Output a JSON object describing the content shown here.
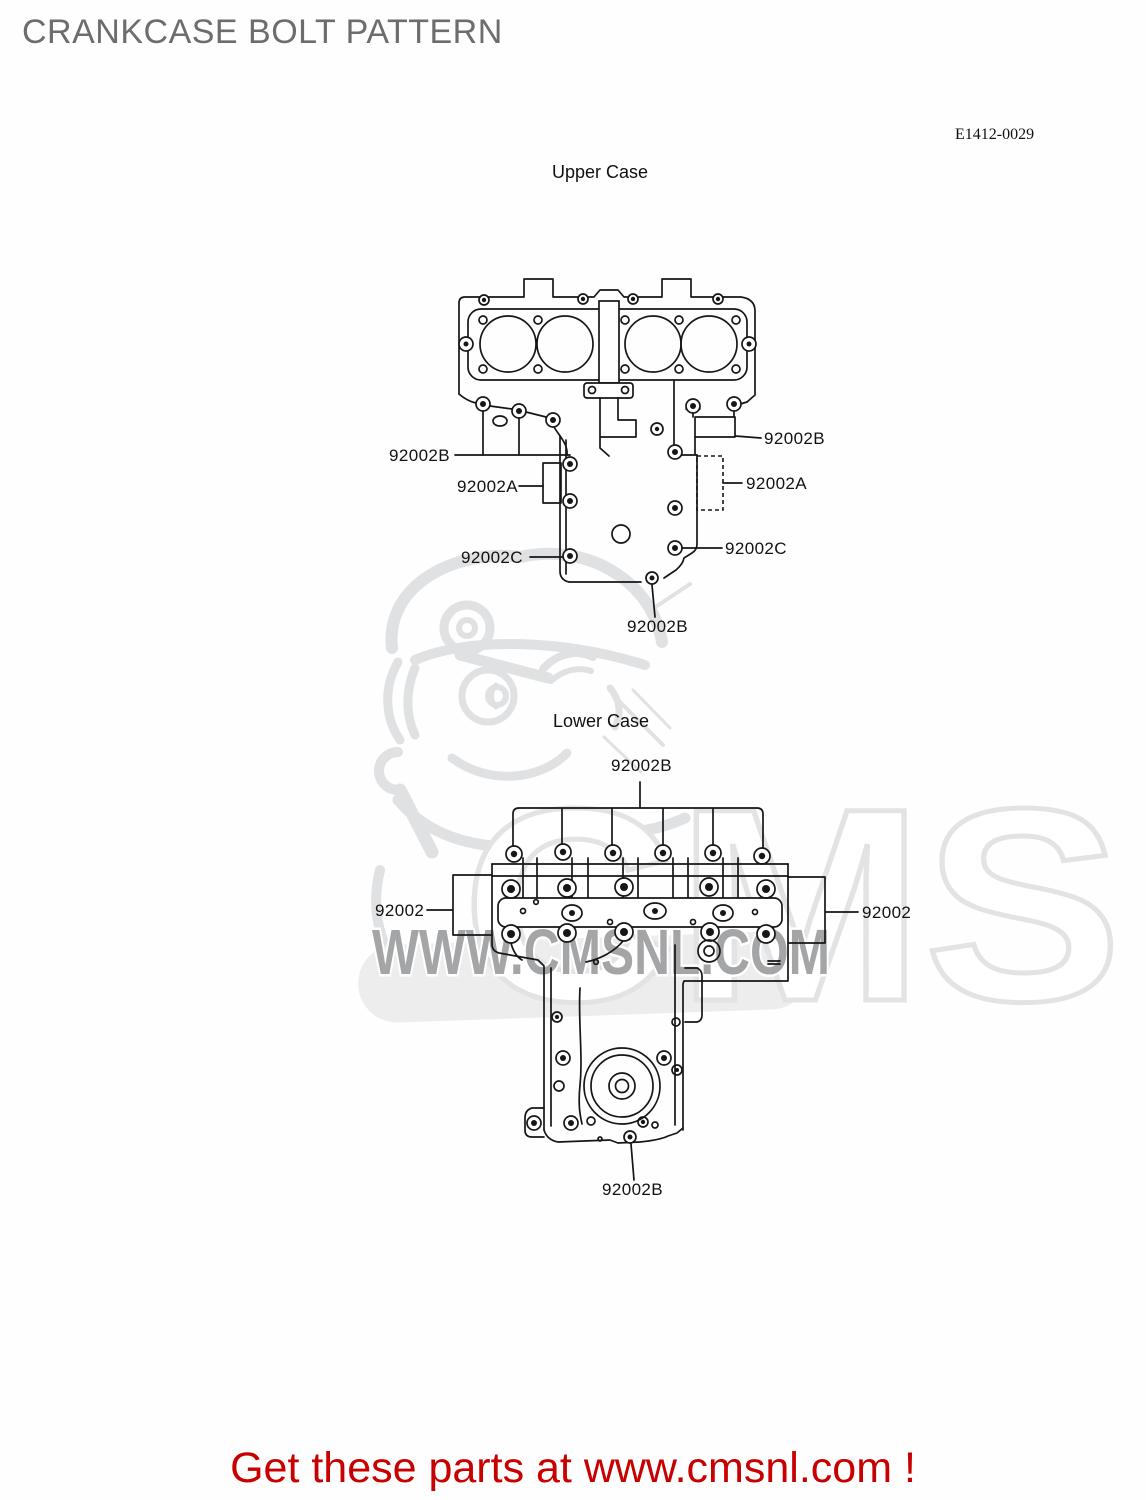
{
  "page": {
    "title": "CRANKCASE BOLT PATTERN",
    "drawing_code": "E1412-0029",
    "footer_text": "Get these parts at www.cmsnl.com !"
  },
  "upper_diagram": {
    "caption": "Upper Case",
    "labels": [
      {
        "text": "92002B",
        "position": "left"
      },
      {
        "text": "92002A",
        "position": "left"
      },
      {
        "text": "92002C",
        "position": "left"
      },
      {
        "text": "92002B",
        "position": "right"
      },
      {
        "text": "92002A",
        "position": "right"
      },
      {
        "text": "92002C",
        "position": "right"
      },
      {
        "text": "92002B",
        "position": "bottom"
      }
    ]
  },
  "lower_diagram": {
    "caption": "Lower Case",
    "labels": [
      {
        "text": "92002B",
        "position": "top"
      },
      {
        "text": "92002",
        "position": "left"
      },
      {
        "text": "92002",
        "position": "right"
      },
      {
        "text": "92002B",
        "position": "bottom"
      }
    ]
  },
  "watermark": {
    "brand": "CMS",
    "url": "WWW.CMSNL.COM",
    "mascot": "cms-winking-mascot"
  },
  "colors": {
    "footer_red": "#c90000",
    "title_gray": "#6d6d6d",
    "line_black": "#161616",
    "watermark_text_gray": "#a4a5a7",
    "watermark_light_gray": "#e2e3e5"
  }
}
